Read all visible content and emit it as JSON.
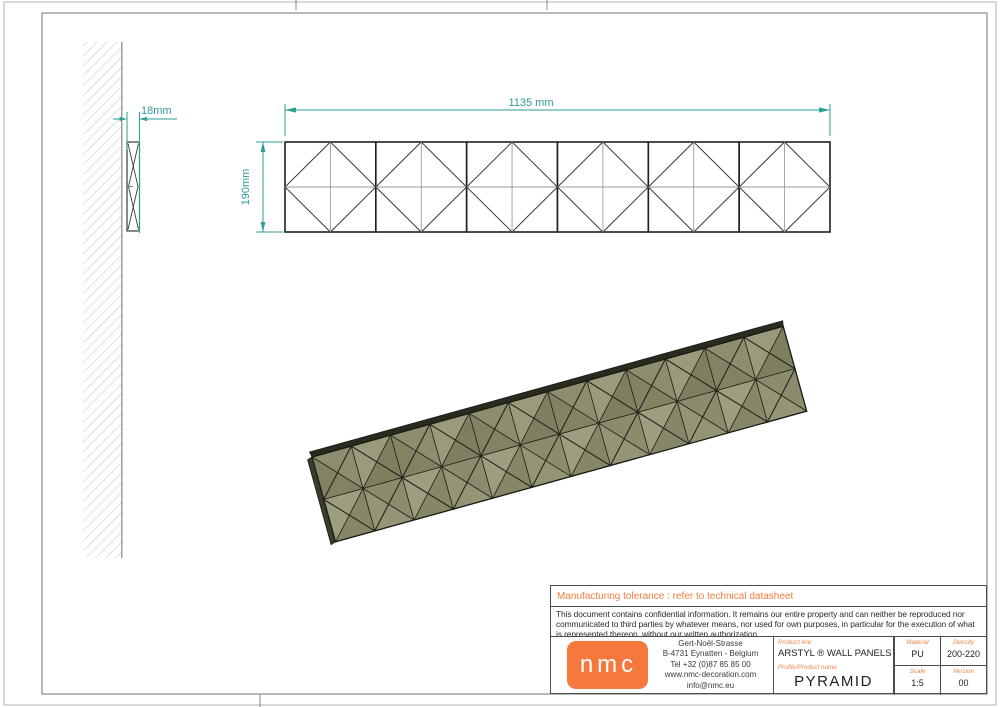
{
  "dims": {
    "thickness": "18mm",
    "height": "190mm",
    "width": "1135 mm"
  },
  "tolerance_note": "Manufacturing tolerance : refer to technical datasheet",
  "confidentiality_note": "This document contains confidential information. It remains our entire property and can neither be reproduced nor communicated to third parties by whatever means, nor used for own purposes, in particular for the execution of what is represented thereon, without our written authorization.",
  "company": {
    "logo_text": "nmc",
    "address_lines": [
      "Gert-Noël-Strasse",
      "B-4731 Eynatten - Belgium",
      "Tel +32 (0)87 85 85 00",
      "www.nmc-decoration.com",
      "info@nmc.eu"
    ]
  },
  "title_block": {
    "product_line_label": "Product line",
    "product_line": "ARSTYL ® WALL PANELS",
    "product_name_label": "Profile/Product name",
    "product_name": "PYRAMID",
    "material_label": "Material",
    "material": "PU",
    "density_label": "Density",
    "density": "200-220",
    "scale_label": "Scale",
    "scale": "1:5",
    "version_label": "Version",
    "version": "00"
  },
  "colors": {
    "accent_orange": "#f5793c",
    "dimension_teal": "#2e9e99",
    "panel_olive": "#8e8e6f"
  }
}
